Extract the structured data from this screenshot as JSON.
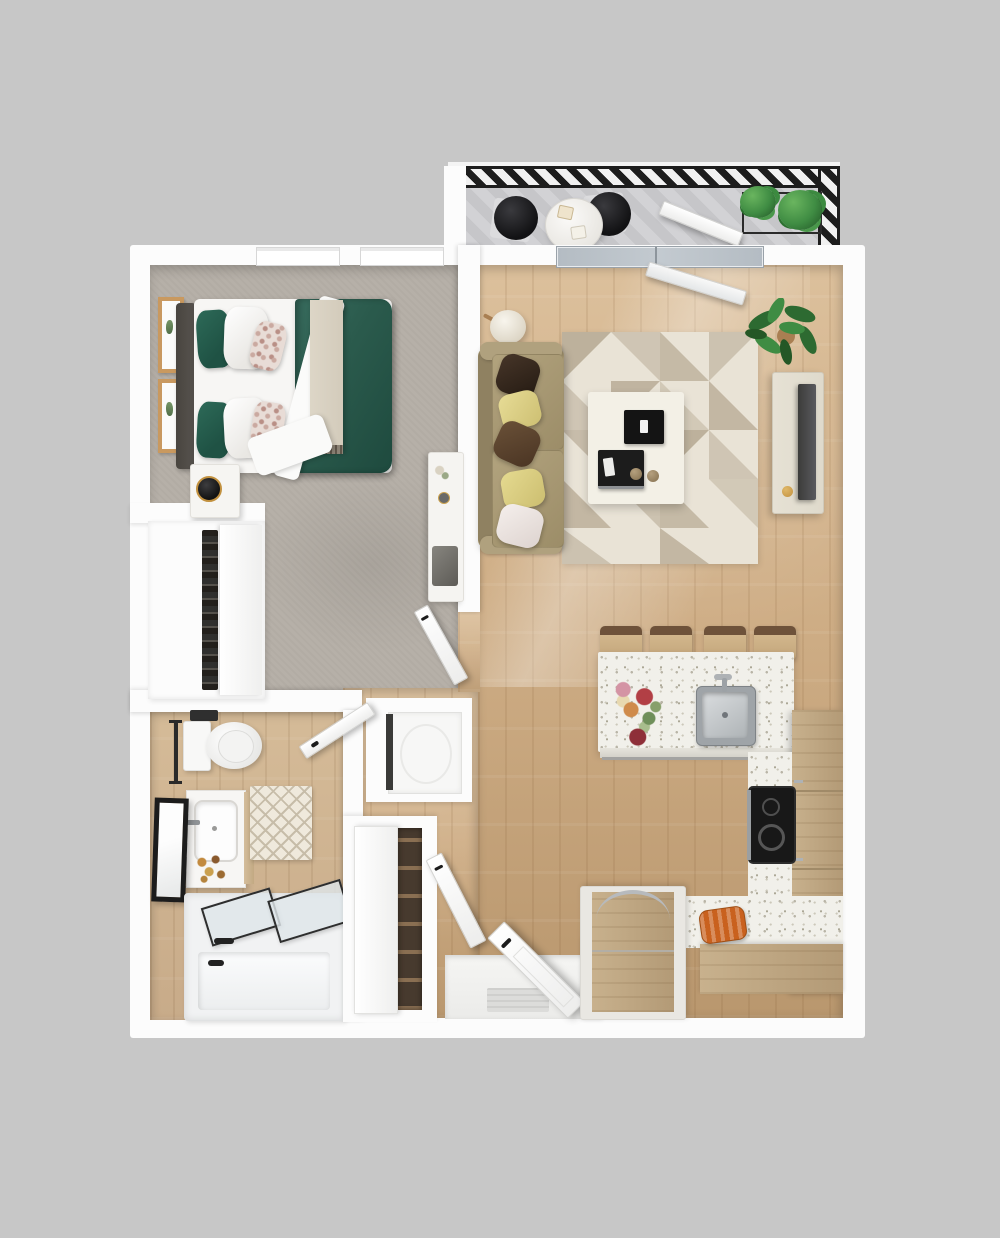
{
  "scene": {
    "type": "3d-floor-plan-render",
    "unit": "one-bedroom-one-bath-apartment-with-balcony"
  },
  "palette": {
    "background": "#c7c7c7",
    "wall": "#fcfcfc",
    "carpet": "#b6b0a8",
    "wood": "#cfae86",
    "woodDark": "#b9976e",
    "woodLight": "#dcc09c",
    "bathWood": "#c8ab89",
    "deck": "#d2d2d5",
    "deckStripe": "#c6c6c9",
    "railing": "#1d1d1d",
    "glass": "#b4bcc3",
    "duvet": "#2b5b4d",
    "pillowGreen": "#1f5244",
    "headboard": "#585450",
    "throwBeige": "#d3cbbb",
    "frameWood": "#c9995f",
    "sofa": "#a3946f",
    "sofaDark": "#8f8161",
    "pillowYellow": "#ddd189",
    "rugBase": "#e9e3d6",
    "rugAccent": "#b5a892",
    "tableWhite": "#f3f0e6",
    "consoleWood": "#dfdacc",
    "tvScreen": "#4a4a48",
    "counter": "#f1f0ea",
    "counterSpeckle": "#b9b5a7",
    "cabinet": "#c8b18d",
    "cabinetDark": "#b39a76",
    "cooktop": "#181818",
    "steel": "#aeb2b5",
    "plant": "#3f8c43",
    "plantDark": "#27602b",
    "potTan": "#a97f52",
    "tub": "#f1f2f3",
    "accentOrange": "#c9611e",
    "clockGold": "#c2913f",
    "matGray": "#dcdcda"
  },
  "rooms": [
    {
      "name": "balcony",
      "items": [
        "deck",
        "hatched-railing",
        "bistro-table",
        "bistro-chair",
        "bistro-chair",
        "planter-box",
        "potted-plants",
        "open-balcony-door"
      ]
    },
    {
      "name": "bedroom",
      "items": [
        "double-bed",
        "green-duvet",
        "headboard",
        "throw-blanket",
        "pillows",
        "nightstand",
        "alarm-clock",
        "wall-art-frames",
        "desk",
        "windows",
        "reach-in-closet",
        "bedroom-door"
      ]
    },
    {
      "name": "bathroom",
      "items": [
        "toilet",
        "towel-bar",
        "vanity-sink",
        "leaning-mirror",
        "diamond-rug",
        "bathtub-with-glass-doors",
        "black-faucet"
      ]
    },
    {
      "name": "hallway",
      "items": [
        "washer-dryer-closet",
        "linen-closet-with-shelves",
        "closet-door",
        "entry-door",
        "door-mat"
      ]
    },
    {
      "name": "living-room",
      "items": [
        "sofa",
        "throw-pillows",
        "floor-lamp",
        "geometric-area-rug",
        "coffee-table",
        "decor-trays",
        "tv-console",
        "tv",
        "potted-plant",
        "sliding-glass-door"
      ]
    },
    {
      "name": "kitchen",
      "items": [
        "peninsula-counter",
        "stainless-sink",
        "faucet",
        "bar-stools",
        "flower-bouquet",
        "cooktop",
        "tall-cabinets",
        "base-cabinets",
        "refrigerator",
        "bread-board"
      ]
    }
  ]
}
